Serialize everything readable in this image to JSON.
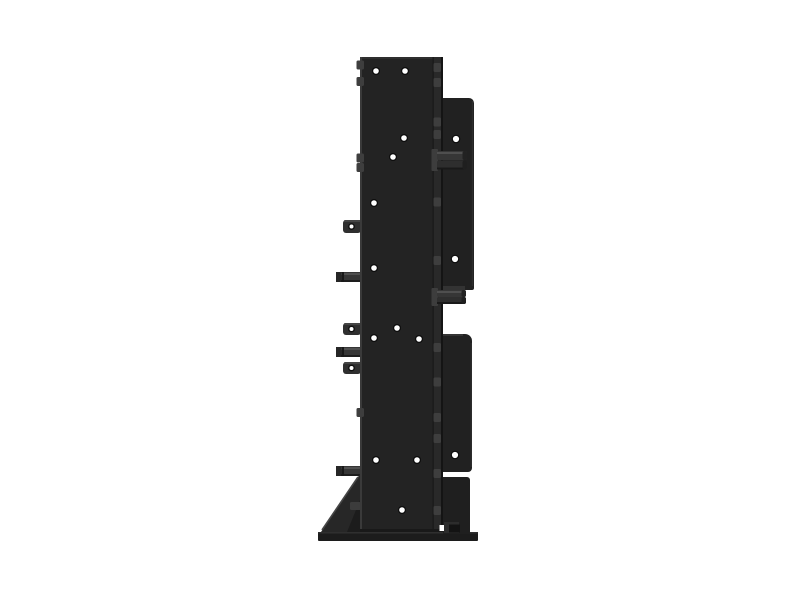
{
  "meta": {
    "object": "black-steel-mounting-bracket-side-view",
    "background": "#ffffff",
    "canvas": {
      "width": 800,
      "height": 600
    }
  },
  "palette": {
    "plate_face": "#232323",
    "plate_fold": "#292929",
    "plate_edge_light": "#3a3a3a",
    "plate_edge_dark": "#151515",
    "right_plate": "#212121",
    "pin_shaft": "#363636",
    "pin_highlight": "#4f4f4f",
    "pin_shadow": "#1d1d1d",
    "tab_face": "#2f2f2f",
    "nub": "#3e3e3e",
    "gusset": "#272727",
    "gusset_shadow": "#1c1c1c",
    "base": "#1c1c1c",
    "hole_rim": "#0c0c0c",
    "hole": "#ffffff"
  },
  "render": {
    "left_tabs": [
      {
        "y": 220,
        "h": 13
      },
      {
        "y": 323,
        "h": 12
      },
      {
        "y": 362,
        "h": 12
      }
    ],
    "left_pins": [
      {
        "y": 272
      },
      {
        "y": 347
      },
      {
        "y": 466
      }
    ],
    "right_pin_pairs": [
      {
        "boss_y": 149,
        "boss_h": 22,
        "y1": 151,
        "y2": 160.5,
        "row_h": 9,
        "len": 30
      },
      {
        "boss_y": 288,
        "boss_h": 18,
        "y1": 290,
        "y2": 297,
        "row_h": 7,
        "len": 29
      }
    ],
    "edge_nubs": [
      {
        "x": 356.5,
        "y": 60.5
      },
      {
        "x": 356.5,
        "y": 77
      },
      {
        "x": 356.5,
        "y": 153.5
      },
      {
        "x": 356.5,
        "y": 163
      },
      {
        "x": 356.5,
        "y": 408
      },
      {
        "x": 433.5,
        "y": 63
      },
      {
        "x": 433.5,
        "y": 78
      },
      {
        "x": 433.5,
        "y": 117.5
      },
      {
        "x": 433.5,
        "y": 130
      },
      {
        "x": 433.5,
        "y": 197.5
      },
      {
        "x": 433.5,
        "y": 256
      },
      {
        "x": 433.5,
        "y": 343
      },
      {
        "x": 433.5,
        "y": 377.5
      },
      {
        "x": 433.5,
        "y": 413
      },
      {
        "x": 433.5,
        "y": 434
      },
      {
        "x": 433.5,
        "y": 469
      },
      {
        "x": 433.5,
        "y": 506
      }
    ],
    "holes": [
      {
        "cx": 376,
        "cy": 71,
        "r": 2.8
      },
      {
        "cx": 405,
        "cy": 71,
        "r": 2.8
      },
      {
        "cx": 404,
        "cy": 138,
        "r": 2.8
      },
      {
        "cx": 393,
        "cy": 157,
        "r": 2.8
      },
      {
        "cx": 374,
        "cy": 203,
        "r": 2.8
      },
      {
        "cx": 374,
        "cy": 268,
        "r": 2.8
      },
      {
        "cx": 397,
        "cy": 328,
        "r": 2.8
      },
      {
        "cx": 374,
        "cy": 338,
        "r": 2.8
      },
      {
        "cx": 419,
        "cy": 339,
        "r": 2.8
      },
      {
        "cx": 376,
        "cy": 460,
        "r": 2.8
      },
      {
        "cx": 417,
        "cy": 460,
        "r": 2.8
      },
      {
        "cx": 402,
        "cy": 510,
        "r": 2.8
      },
      {
        "cx": 456,
        "cy": 139,
        "r": 3.1
      },
      {
        "cx": 455,
        "cy": 259,
        "r": 3.1
      },
      {
        "cx": 455,
        "cy": 455,
        "r": 3.1
      }
    ],
    "shapes": [
      {
        "name": "gusset-main",
        "kind": "polygon",
        "attrs": {
          "points": "360,474 360,532 321,532",
          "fill": "#272727"
        }
      },
      {
        "name": "gusset-edge-highlight",
        "kind": "line",
        "attrs": {
          "x1": 358,
          "y1": 477,
          "x2": 322,
          "y2": 530,
          "stroke": "#464646",
          "stroke-width": "1.6"
        }
      },
      {
        "name": "gusset-inner-shadow",
        "kind": "polygon",
        "attrs": {
          "points": "360,500 360,532 347,532",
          "fill": "#1c1c1c"
        }
      },
      {
        "name": "gusset-nub",
        "kind": "rect",
        "attrs": {
          "x": 350,
          "y": 502,
          "width": 11,
          "height": 8,
          "rx": 1.5,
          "fill": "#3c3c3c"
        }
      },
      {
        "name": "base-bar",
        "kind": "rect",
        "attrs": {
          "x": 318,
          "y": 532,
          "width": 160,
          "height": 9,
          "rx": 1,
          "fill": "#1c1c1c"
        }
      },
      {
        "name": "base-top-edge",
        "kind": "rect",
        "attrs": {
          "x": 318,
          "y": 532,
          "width": 160,
          "height": 1.5,
          "fill": "#2f2f2f"
        }
      },
      {
        "name": "main-plate",
        "kind": "rect",
        "attrs": {
          "x": 360,
          "y": 57,
          "width": 83,
          "height": 475,
          "fill": "#232323"
        }
      },
      {
        "name": "main-plate-top-edge",
        "kind": "rect",
        "attrs": {
          "x": 360,
          "y": 57,
          "width": 83,
          "height": 2,
          "fill": "#2e2e2e"
        }
      },
      {
        "name": "main-plate-left-edge",
        "kind": "rect",
        "attrs": {
          "x": 360,
          "y": 57,
          "width": 2,
          "height": 475,
          "fill": "#3a3a3a"
        }
      },
      {
        "name": "main-plate-fold-strip",
        "kind": "rect",
        "attrs": {
          "x": 433,
          "y": 57,
          "width": 8,
          "height": 475,
          "fill": "#292929"
        }
      },
      {
        "name": "main-plate-fold-line",
        "kind": "rect",
        "attrs": {
          "x": 432.5,
          "y": 57,
          "width": 1.2,
          "height": 475,
          "fill": "#181818"
        }
      },
      {
        "name": "main-plate-right-edge",
        "kind": "rect",
        "attrs": {
          "x": 441,
          "y": 57,
          "width": 2,
          "height": 475,
          "fill": "#141414"
        }
      },
      {
        "name": "main-plate-bottom-shade",
        "kind": "rect",
        "attrs": {
          "x": 360,
          "y": 529,
          "width": 83,
          "height": 3,
          "fill": "#191919"
        }
      },
      {
        "name": "right-plate-upper",
        "kind": "path",
        "attrs": {
          "d": "M443,98 h26 a5,5 0 0 1 5,5 V288 a2,2 0 0 1 -2,2 H443 Z",
          "fill": "#212121"
        }
      },
      {
        "name": "right-plate-upper-edge",
        "kind": "rect",
        "attrs": {
          "x": 471.8,
          "y": 101,
          "width": 1.4,
          "height": 185,
          "fill": "#2d2d2d"
        }
      },
      {
        "name": "right-plate-upper-ledge",
        "kind": "rect",
        "attrs": {
          "x": 443,
          "y": 286,
          "width": 22,
          "height": 4,
          "fill": "#333333"
        }
      },
      {
        "name": "right-plate-lower",
        "kind": "path",
        "attrs": {
          "d": "M443,334 h22 a7,7 0 0 1 7,7 V468 a4,4 0 0 1 -4,4 H443 Z",
          "fill": "#212121"
        }
      },
      {
        "name": "right-plate-lower-top-edge",
        "kind": "rect",
        "attrs": {
          "x": 443,
          "y": 334,
          "width": 20,
          "height": 2,
          "fill": "#343434"
        }
      },
      {
        "name": "right-plate-lower-edge",
        "kind": "rect",
        "attrs": {
          "x": 470.6,
          "y": 343,
          "width": 1.4,
          "height": 124,
          "fill": "#2d2d2d"
        }
      },
      {
        "name": "foot-plate",
        "kind": "path",
        "attrs": {
          "d": "M443,477 h24 a3,3 0 0 1 3,3 V534 H443 Z",
          "fill": "#1f1f1f"
        }
      },
      {
        "name": "foot-notch",
        "kind": "rect",
        "attrs": {
          "x": 439.5,
          "y": 525,
          "width": 4.5,
          "height": 6,
          "fill": "#ffffff"
        }
      },
      {
        "name": "foot-block",
        "kind": "rect",
        "attrs": {
          "x": 444,
          "y": 522,
          "width": 15,
          "height": 11,
          "fill": "#2c2c2c"
        }
      },
      {
        "name": "foot-block-dark",
        "kind": "rect",
        "attrs": {
          "x": 449,
          "y": 524.5,
          "width": 11,
          "height": 8,
          "fill": "#131313"
        }
      }
    ]
  }
}
